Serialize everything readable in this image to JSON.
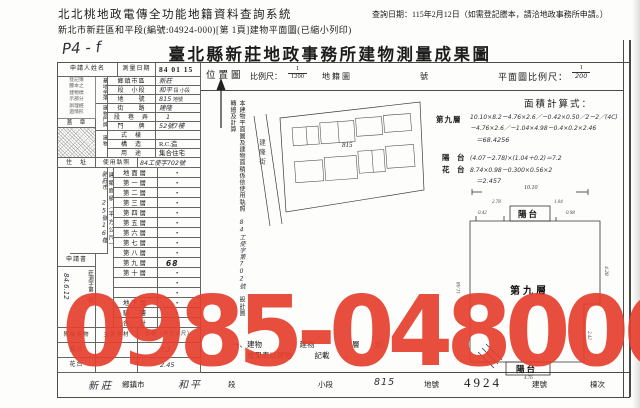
{
  "header": {
    "system_title": "北北桃地政電傳全功能地籍資料查詢系統",
    "doc_line": "新北市新莊區和平段(編號:04924-000)[第 1頁]建物平面圖(已縮小列印)",
    "query_date": "查詢日期：115年2月12日（如需登記謄本，請洽地政事務所申請。）"
  },
  "sheet": {
    "hand_code": "P4 - f",
    "title": "臺北縣新莊地政事務所建物測量成果圖",
    "watermark": "0985-048006",
    "form": {
      "applicant_label": "申請人姓名",
      "survey_date_label": "測量日期",
      "survey_date_value": "84 01 15",
      "memo_lines": [
        "登記簿",
        "謄本之",
        "建物標",
        "示部分",
        "辦理經",
        "過情形"
      ],
      "seal_label": "蓋　章",
      "site_group": "基地坐落",
      "site_rows": [
        {
          "label": "鄉鎮市區",
          "value": "新莊",
          "suffix": ""
        },
        {
          "label": "段　小段",
          "value": "和平",
          "suffix": "段 小段"
        },
        {
          "label": "地　　號",
          "value": "815",
          "suffix": "地號"
        }
      ],
      "door_group": "建物門牌",
      "door_rows": [
        {
          "label": "街　　路",
          "value": "建隆",
          "suffix": ""
        },
        {
          "label": "段　巷　弄",
          "value": "1",
          "suffix": ""
        },
        {
          "label": "門　　牌",
          "value": "52號7樓",
          "suffix": ""
        }
      ],
      "bldg_group": "建物",
      "bldg_rows": [
        {
          "label": "式　樣",
          "value": "",
          "suffix": ""
        },
        {
          "label": "構　造",
          "value": "R.C.造",
          "suffix": ""
        },
        {
          "label": "用　途",
          "value": "集合住宅",
          "suffix": ""
        }
      ],
      "license_label": "使用執照",
      "license_value": "84工使字702號",
      "addr_label": "住　址",
      "addr_value": "新莊市 25號16樓",
      "application_label": "申請書",
      "application_field": "莊測字第　號",
      "application_value": "84.6.12",
      "floors_group": "建築面積（平方公尺）",
      "floor_rows": [
        {
          "label": "地面層",
          "value": "•"
        },
        {
          "label": "第一層",
          "value": "•"
        },
        {
          "label": "第二層",
          "value": "•"
        },
        {
          "label": "第三層",
          "value": "•"
        },
        {
          "label": "第四層",
          "value": "•"
        },
        {
          "label": "第五層",
          "value": "•"
        },
        {
          "label": "第六層",
          "value": "•"
        },
        {
          "label": "第七層",
          "value": "•"
        },
        {
          "label": "第八層",
          "value": "•"
        },
        {
          "label": "第九層",
          "value": "68 •33"
        },
        {
          "label": "第十層",
          "value": "•"
        },
        {
          "label": "",
          "value": "•"
        },
        {
          "label": "",
          "value": "•"
        },
        {
          "label": "地下層",
          "value": "•"
        },
        {
          "label": "騎　樓",
          "value": "•"
        },
        {
          "label": "合　計",
          "value": "•"
        }
      ],
      "annex_headers": [
        "附屬建物",
        "主要建材",
        "面積（平方公尺）"
      ],
      "annex_rows": [
        {
          "name": "陽台",
          "material": "",
          "area": "7.2"
        },
        {
          "name": "花台",
          "material": "",
          "area": "2.45"
        }
      ]
    },
    "side_note": {
      "part1": "本建物平面圖及建物面積係依使用執照",
      "hand": "84工使字第702號",
      "part2": "設計圖轉繪及計算"
    },
    "location": {
      "label": "位置圖",
      "scale_label": "比例尺：",
      "scale_num": "1",
      "scale_den": "1200",
      "sheet_label": "地籍圖",
      "no_label": "號",
      "parcel": "815",
      "street": "建隆街"
    },
    "plan": {
      "scale_label": "平面圖比例尺：",
      "scale_num": "1",
      "scale_den": "200",
      "calc_label": "面積計算式：",
      "calc": [
        {
          "label": "第九層",
          "l1": "10.10×8.2－4.76×2.6／－0.42×0.50／2－2／(4C)",
          "l2": "－4.76×2.6／－1.04×4.98－0.4×0.2×2.46",
          "l3": "＝68.4256"
        },
        {
          "label": "陽　台",
          "l1": "(4.07－2.78)×(1.04＋0.2)＝7.2",
          "l2": "",
          "l3": ""
        },
        {
          "label": "花　台",
          "l1": "8.74×0.98－0.300×0.56×2",
          "l2": "＝2.457",
          "l3": ""
        }
      ],
      "drawing": {
        "room": "第九層",
        "balcony_top": "陽台",
        "balcony_bottom": "陽台",
        "dim_top": "10.10",
        "dim_left": "11.08",
        "dim_right": "4.28",
        "dim_a": "2.78",
        "dim_b": "1.04",
        "dim_c": "0.42",
        "dim_d": "0.98",
        "dim_e": "2.42",
        "dim_f": "4.76"
      }
    },
    "notes": [
      "一、建物　　　　　建物　　　　　層　　分。",
      "　　成果表以建物　　　記載　　。"
    ],
    "footer": {
      "v1": "新莊",
      "l1": "鄉鎮市",
      "v2": "和平",
      "l2": "段",
      "l3": "小段",
      "v3": "815",
      "l4": "地號",
      "v4": "4924",
      "l5": "建號",
      "l6": "棟次"
    }
  }
}
